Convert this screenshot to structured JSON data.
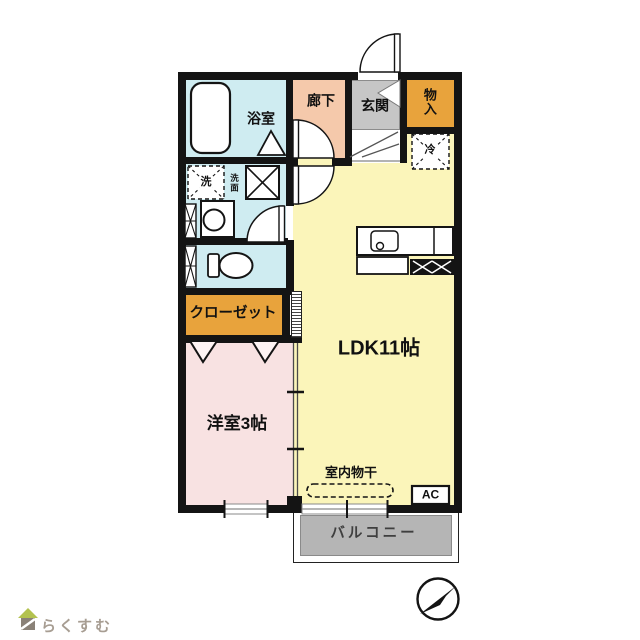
{
  "floorplan": {
    "rooms": {
      "bathroom": "浴室",
      "hallway": "廊下",
      "entrance": "玄関",
      "storage": "物入",
      "refrigerator": "冷",
      "washer": "洗",
      "washbasin": "洗面",
      "closet": "クローゼット",
      "ldk": "LDK11帖",
      "western_room": "洋室3帖",
      "indoor_drying": "室内物干",
      "air_conditioner": "AC",
      "balcony": "バルコニー"
    },
    "colors": {
      "ldk_yellow": "#fbf5ba",
      "hallway_salmon": "#f5c9ab",
      "entrance_gray": "#c6c6c6",
      "storage_orange": "#e8a33c",
      "wet_area_blue": "#cfecf1",
      "western_pink": "#f8e2e2",
      "balcony_gray": "#b5b5b5",
      "wall_black": "#141414"
    }
  },
  "branding": {
    "logo_text": "らくすむ"
  }
}
